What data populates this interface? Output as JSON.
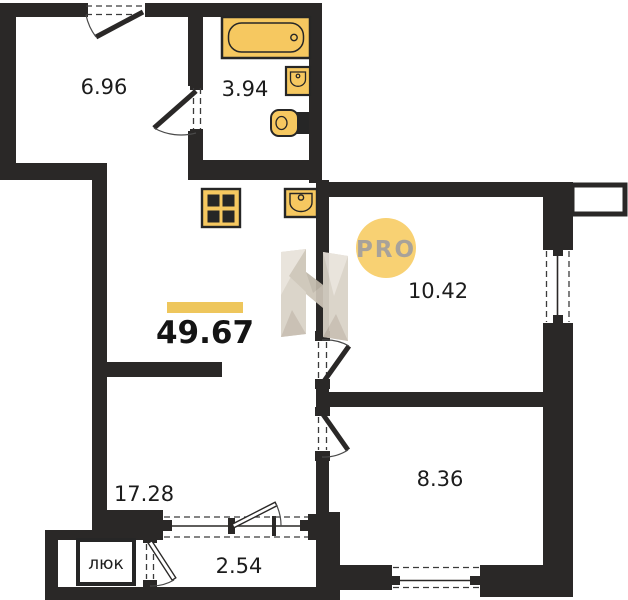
{
  "plan": {
    "total": {
      "area": "49.67"
    },
    "rooms": {
      "topLeft": "6.96",
      "bath": "3.94",
      "bedroom": "10.42",
      "living": "17.28",
      "bedroom2": "8.36",
      "loggia": "2.54"
    },
    "hatch": "люк",
    "badge": "PRO",
    "icons": [
      "bathtub-icon",
      "sink-icon",
      "toilet-icon",
      "stove-icon",
      "kitchen-sink-icon",
      "door-swing-icon",
      "window-icon",
      "hatch-box"
    ],
    "colors": {
      "wall": "#2a2827",
      "fixture_fill": "#f6c860",
      "accent_bar": "#eec65c",
      "badge_bg": "#f8d173",
      "badge_text": "#a8a29a",
      "watermark_beige": "#d9d2c7"
    }
  }
}
